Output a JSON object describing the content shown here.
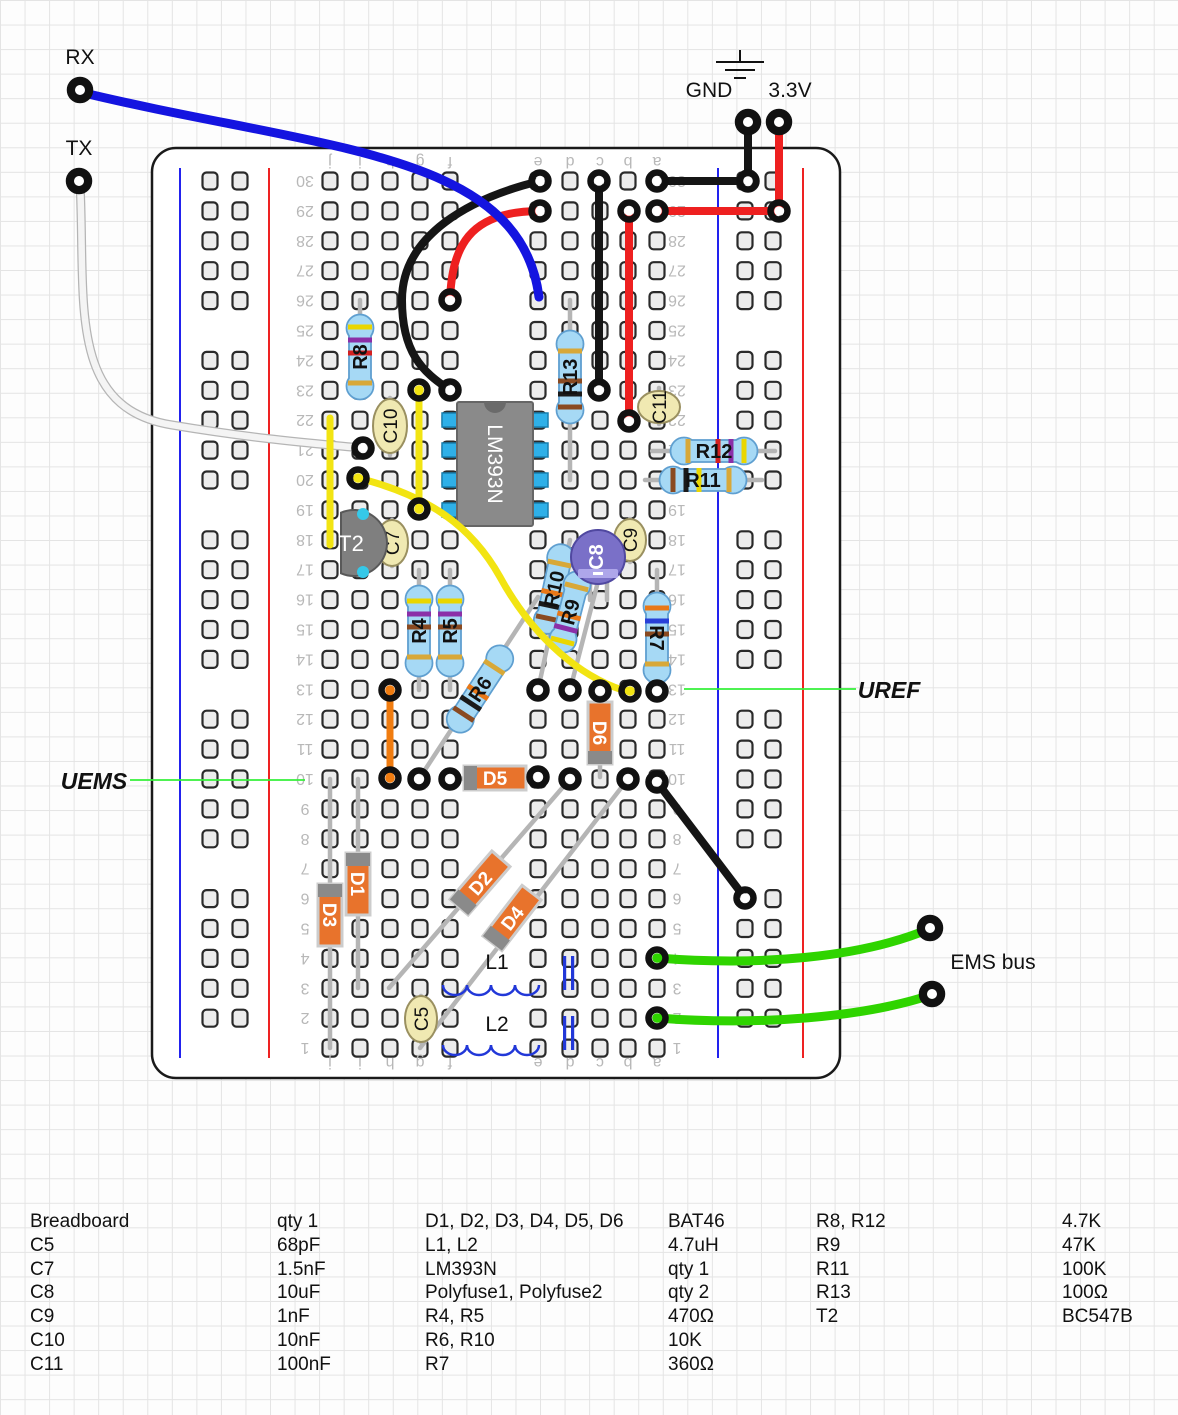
{
  "labels": {
    "rx": "RX",
    "tx": "TX",
    "gnd": "GND",
    "v33": "3.3V",
    "uref": "UREF",
    "uems": "UEMS",
    "ems_bus": "EMS bus"
  },
  "colors": {
    "board_fill": "#ffffff",
    "board_stroke": "#1a1a1a",
    "hole_fill": "#ececec",
    "hole_stroke": "#2a2a2a",
    "rail_blue": "#2222ee",
    "rail_red": "#ee2222",
    "row_label": "#b8b8b8",
    "wire_black": "#151515",
    "wire_red": "#ee2020",
    "wire_blue": "#1414e0",
    "wire_yellow": "#f2e412",
    "wire_orange": "#f07c10",
    "wire_green": "#2fd400",
    "wire_white": "#f4f4f4",
    "wire_white_outline": "#b5b5b5",
    "lead_gray": "#b5b5b5",
    "resistor_body": "#a6d9f5",
    "resistor_stroke": "#5f9fd0",
    "diode_body": "#e8732c",
    "diode_stroke": "#cccccc",
    "diode_band": "#8a8a8a",
    "cap_body": "#f0e9b2",
    "cap_stroke": "#9a9060",
    "electro_body": "#7a70c8",
    "electro_stroke": "#5048a0",
    "electro_stripe": "#aea6ea",
    "transistor_body": "#7f7f7f",
    "transistor_stroke": "#595959",
    "transistor_pin": "#35c8e8",
    "ic_body": "#8a8a8a",
    "ic_stroke": "#666666",
    "ic_pin": "#2fb0e8",
    "ic_notch": "#6a6a6a",
    "inductor_blue": "#2238d8",
    "callout_green": "#35f03a",
    "band_colors": {
      "yellow": "#ead600",
      "violet": "#8b2fa8",
      "red": "#d42020",
      "brown": "#8a4a21",
      "black": "#1a1a1a",
      "orange": "#e87818",
      "blue": "#2840d8",
      "gold": "#d8a838"
    }
  },
  "board": {
    "x": 152,
    "y": 148,
    "w": 688,
    "h": 930,
    "radius": 24,
    "rows": 30,
    "row30_y": 181,
    "row_pitch": 29.9,
    "col_letters": [
      "j",
      "i",
      "h",
      "g",
      "f",
      "e",
      "d",
      "c",
      "b",
      "a"
    ],
    "col_x": [
      330,
      360,
      390,
      420,
      450,
      538,
      570,
      600,
      628,
      657
    ],
    "letters_top_y": 162,
    "letters_bottom_y": 1063,
    "row_label_left_x": 305,
    "row_label_right_x": 677,
    "rails": {
      "left": {
        "blue_line_x": 180,
        "red_line_x": 269,
        "hole_x": [
          210,
          240
        ]
      },
      "right": {
        "blue_line_x": 718,
        "red_line_x": 803,
        "hole_x": [
          745,
          773
        ]
      },
      "groups": [
        [
          30,
          26
        ],
        [
          24,
          20
        ],
        [
          18,
          14
        ],
        [
          12,
          8
        ],
        [
          6,
          2
        ]
      ]
    }
  },
  "ic": {
    "ref": "LM393N",
    "x": 457,
    "y": 402,
    "w": 76,
    "h": 124,
    "pin_rows": [
      420,
      450,
      480,
      510
    ]
  },
  "transistor": {
    "ref": "T2",
    "cx": 354,
    "cy": 543,
    "r": 33,
    "flat_x": 341,
    "pins": [
      [
        363,
        514
      ],
      [
        363,
        572
      ]
    ],
    "label_x": 351,
    "label_y": 551
  },
  "resistors": [
    {
      "ref": "R8",
      "value": "4.7K",
      "lead": [
        360,
        300,
        360,
        390
      ],
      "cx": 360,
      "cy": 357,
      "len": 82,
      "angle": -90,
      "bands": [
        "yellow",
        "violet",
        "red"
      ],
      "flip": true
    },
    {
      "ref": "R13",
      "value": "100",
      "lead": [
        570,
        300,
        570,
        480
      ],
      "cx": 570,
      "cy": 377,
      "len": 90,
      "angle": -90,
      "bands": [
        "brown",
        "black",
        "brown"
      ],
      "flip": false
    },
    {
      "ref": "R4",
      "value": "470",
      "lead": [
        419,
        570,
        419,
        690
      ],
      "cx": 419,
      "cy": 631,
      "len": 88,
      "angle": -90,
      "bands": [
        "yellow",
        "violet",
        "brown"
      ],
      "flip": true
    },
    {
      "ref": "R5",
      "value": "470",
      "lead": [
        450,
        570,
        450,
        690
      ],
      "cx": 450,
      "cy": 631,
      "len": 88,
      "angle": -90,
      "bands": [
        "yellow",
        "violet",
        "brown"
      ],
      "flip": true
    },
    {
      "ref": "R6",
      "value": "10K",
      "lead": [
        419,
        779,
        538,
        597
      ],
      "cx": 480,
      "cy": 689,
      "len": 96,
      "angle": -56.8,
      "bands": [
        "brown",
        "black",
        "orange"
      ],
      "flip": false
    },
    {
      "ref": "R10",
      "value": "10K",
      "lead": [
        538,
        690,
        570,
        540
      ],
      "cx": 554,
      "cy": 589,
      "len": 88,
      "angle": -78,
      "bands": [
        "brown",
        "black",
        "orange"
      ],
      "flip": false
    },
    {
      "ref": "R9",
      "value": "47K",
      "lead": [
        570,
        690,
        601,
        570
      ],
      "cx": 570,
      "cy": 612,
      "len": 80,
      "angle": -75.5,
      "bands": [
        "yellow",
        "violet",
        "orange"
      ],
      "flip": false
    },
    {
      "ref": "R7",
      "value": "360",
      "lead": [
        657,
        570,
        657,
        691
      ],
      "cx": 657,
      "cy": 638,
      "len": 88,
      "angle": 90,
      "bands": [
        "orange",
        "blue",
        "brown"
      ],
      "flip": false
    },
    {
      "ref": "R12",
      "value": "4.7K",
      "lead": [
        652,
        451,
        775,
        451
      ],
      "cx": 714,
      "cy": 451,
      "len": 84,
      "angle": 0,
      "bands": [
        "yellow",
        "violet",
        "red"
      ],
      "flip": true
    },
    {
      "ref": "R11",
      "value": "100K",
      "lead": [
        645,
        480,
        762,
        480
      ],
      "cx": 703,
      "cy": 480,
      "len": 84,
      "angle": 0,
      "bands": [
        "brown",
        "black",
        "yellow"
      ],
      "flip": false
    }
  ],
  "diodes": [
    {
      "ref": "D5",
      "lead": [
        447,
        779,
        538,
        777
      ],
      "cx": 495,
      "cy": 778,
      "len": 62,
      "angle": 0,
      "band_side": -1
    },
    {
      "ref": "D6",
      "lead": [
        600,
        691,
        600,
        777
      ],
      "cx": 600,
      "cy": 733,
      "len": 62,
      "angle": 90,
      "band_side": 1
    },
    {
      "ref": "D3",
      "lead": [
        330,
        779,
        330,
        1048
      ],
      "cx": 330,
      "cy": 915,
      "len": 62,
      "angle": 90,
      "band_side": -1
    },
    {
      "ref": "D1",
      "lead": [
        358,
        779,
        358,
        988
      ],
      "cx": 358,
      "cy": 884,
      "len": 62,
      "angle": 90,
      "band_side": -1
    },
    {
      "ref": "D2",
      "lead": [
        389,
        988,
        570,
        779
      ],
      "cx": 480,
      "cy": 883,
      "len": 64,
      "angle": -49.1,
      "band_side": -1
    },
    {
      "ref": "D4",
      "lead": [
        420,
        1048,
        628,
        779
      ],
      "cx": 512,
      "cy": 918,
      "len": 64,
      "angle": -52.3,
      "band_side": -1
    }
  ],
  "capacitors": [
    {
      "ref": "C10",
      "cx": 390,
      "cy": 426,
      "rx": 17,
      "ry": 27,
      "stub": [
        390,
        398,
        455
      ]
    },
    {
      "ref": "C7",
      "cx": 392,
      "cy": 543,
      "rx": 16,
      "ry": 23,
      "stub": [
        392,
        520,
        566
      ]
    },
    {
      "ref": "C9",
      "cx": 630,
      "cy": 540,
      "rx": 16,
      "ry": 21,
      "stub": [
        630,
        519,
        562
      ]
    },
    {
      "ref": "C5",
      "cx": 421,
      "cy": 1019,
      "rx": 16,
      "ry": 23,
      "stub": [
        421,
        996,
        1042
      ]
    },
    {
      "ref": "C11",
      "cx": 659,
      "cy": 407,
      "rx": 21,
      "ry": 16,
      "stub": [
        659,
        388,
        424
      ]
    }
  ],
  "electrolytic": {
    "ref": "C8",
    "cx": 598,
    "cy": 557,
    "r": 27,
    "minus": "-",
    "stubs": [
      [
        590,
        583,
        600
      ],
      [
        607,
        583,
        600
      ]
    ]
  },
  "inductors": [
    {
      "ref": "L1",
      "path": "M443,985 a12,10 0 0 0 24,0 a12,10 0 0 0 24,0 a12,10 0 0 0 24,0 a12,10 0 0 0 24,0",
      "label_x": 497,
      "label_y": 969
    },
    {
      "ref": "L2",
      "path": "M443,1045 a12,10 0 0 0 24,0 a12,10 0 0 0 24,0 a12,10 0 0 0 24,0 a12,10 0 0 0 24,0",
      "label_x": 497,
      "label_y": 1031
    }
  ],
  "polyfuses": [
    {
      "name": "polyfuse-1",
      "x": 563,
      "y1": 956,
      "y2": 990
    },
    {
      "name": "polyfuse-2",
      "x": 563,
      "y1": 1016,
      "y2": 1050
    }
  ],
  "wires": [
    {
      "name": "wire-tx-white",
      "color": "white",
      "w": 6.5,
      "path": "M80,183 C86,300 66,408 172,425 C262,440 322,444 361,448"
    },
    {
      "name": "wire-gnd-drop",
      "color": "black",
      "w": 8,
      "path": "M748,130 L748,181"
    },
    {
      "name": "wire-gnd-row30",
      "color": "black",
      "w": 8,
      "path": "M657,181 L748,181"
    },
    {
      "name": "wire-33v-drop",
      "color": "red",
      "w": 8,
      "path": "M779,130 L779,211"
    },
    {
      "name": "wire-33v-row29",
      "color": "red",
      "w": 8,
      "path": "M657,211 L779,211"
    },
    {
      "name": "wire-black-vertical",
      "color": "black",
      "w": 8,
      "path": "M599,181 L599,390"
    },
    {
      "name": "wire-red-vertical",
      "color": "red",
      "w": 8,
      "path": "M629,211 L629,421"
    },
    {
      "name": "wire-black-curve",
      "color": "black",
      "w": 8,
      "path": "M540,181 C470,198 402,235 402,300 C402,352 422,372 450,390"
    },
    {
      "name": "wire-red-curve",
      "color": "red",
      "w": 8,
      "path": "M450,300 C452,248 468,211 540,211"
    },
    {
      "name": "wire-rx-blue",
      "color": "blue",
      "w": 9,
      "path": "M80,92 C320,150 520,150 539,297"
    },
    {
      "name": "wire-yellow-left",
      "color": "yellow",
      "w": 7,
      "path": "M330,418 L330,545"
    },
    {
      "name": "wire-yellow-g",
      "color": "yellow",
      "w": 7,
      "path": "M419,390 L419,509"
    },
    {
      "name": "wire-orange",
      "color": "orange",
      "w": 7,
      "path": "M390,690 L390,778"
    },
    {
      "name": "wire-yellow-long",
      "color": "yellow",
      "w": 7,
      "path": "M358,478 C430,496 472,527 500,577 C530,632 572,670 614,687 C622,690 627,691 630,691"
    },
    {
      "name": "wire-black-diagonal",
      "color": "black",
      "w": 8,
      "path": "M657,782 L745,898"
    },
    {
      "name": "wire-green-ems-1",
      "color": "green",
      "w": 9,
      "path": "M657,958 C760,966 860,958 929,929"
    },
    {
      "name": "wire-green-ems-2",
      "color": "green",
      "w": 9,
      "path": "M657,1018 C762,1026 864,1017 931,995"
    }
  ],
  "rings": [
    [
      657,
      181,
      "w"
    ],
    [
      748,
      181,
      "w"
    ],
    [
      657,
      211,
      "w"
    ],
    [
      779,
      211,
      "w"
    ],
    [
      599,
      181,
      "w"
    ],
    [
      599,
      390,
      "w"
    ],
    [
      629,
      211,
      "w"
    ],
    [
      629,
      421,
      "w"
    ],
    [
      540,
      181,
      "w"
    ],
    [
      450,
      390,
      "w"
    ],
    [
      450,
      300,
      "w"
    ],
    [
      540,
      211,
      "w"
    ],
    [
      363,
      448,
      "w"
    ],
    [
      358,
      478,
      "y"
    ],
    [
      630,
      691,
      "y"
    ],
    [
      419,
      390,
      "y"
    ],
    [
      419,
      509,
      "y"
    ],
    [
      390,
      690,
      "o"
    ],
    [
      390,
      778,
      "o"
    ],
    [
      657,
      782,
      "w"
    ],
    [
      745,
      898,
      "w"
    ],
    [
      657,
      958,
      "g"
    ],
    [
      657,
      1018,
      "g"
    ],
    [
      538,
      690,
      "w"
    ],
    [
      570,
      690,
      "w"
    ],
    [
      600,
      691,
      "w"
    ],
    [
      657,
      691,
      "w"
    ],
    [
      538,
      777,
      "w"
    ],
    [
      450,
      779,
      "w"
    ],
    [
      570,
      779,
      "w"
    ],
    [
      628,
      779,
      "w"
    ],
    [
      419,
      779,
      "w"
    ]
  ],
  "pads": [
    {
      "name": "pad-rx",
      "x": 80,
      "y": 90
    },
    {
      "name": "pad-tx",
      "x": 79,
      "y": 181
    },
    {
      "name": "pad-gnd",
      "x": 748,
      "y": 122
    },
    {
      "name": "pad-33v",
      "x": 779,
      "y": 122
    },
    {
      "name": "pad-ems-1",
      "x": 930,
      "y": 928
    },
    {
      "name": "pad-ems-2",
      "x": 932,
      "y": 994
    }
  ],
  "gnd_symbol": {
    "stem": [
      740,
      50,
      740,
      62
    ],
    "bars": [
      [
        716,
        62,
        764,
        62
      ],
      [
        725,
        70,
        755,
        70
      ],
      [
        734,
        78,
        746,
        78
      ]
    ]
  },
  "ext_labels": [
    {
      "key": "rx",
      "x": 80,
      "y": 64,
      "size": 21,
      "style": "plain"
    },
    {
      "key": "tx",
      "x": 79,
      "y": 155,
      "size": 21,
      "style": "plain"
    },
    {
      "key": "gnd",
      "x": 709,
      "y": 97,
      "size": 21,
      "style": "plain"
    },
    {
      "key": "v33",
      "x": 790,
      "y": 97,
      "size": 21,
      "style": "plain"
    },
    {
      "key": "ems_bus",
      "x": 993,
      "y": 969,
      "size": 21,
      "style": "plain"
    },
    {
      "key": "uref",
      "x": 889,
      "y": 698,
      "size": 23,
      "style": "bold-italic"
    },
    {
      "key": "uems",
      "x": 94,
      "y": 789,
      "size": 23,
      "style": "bold-italic"
    }
  ],
  "callout_lines": [
    [
      684,
      689,
      856,
      689
    ],
    [
      130,
      780,
      305,
      780
    ]
  ],
  "parts_list": {
    "top": 1212,
    "row_h": 23.8,
    "groups": [
      {
        "x_name": 30,
        "x_value": 277,
        "rows": [
          [
            "Breadboard",
            "qty 1"
          ],
          [
            "C5",
            "68pF"
          ],
          [
            "C7",
            "1.5nF"
          ],
          [
            "C8",
            "10uF"
          ],
          [
            "C9",
            "1nF"
          ],
          [
            "C10",
            "10nF"
          ],
          [
            "C11",
            "100nF"
          ]
        ]
      },
      {
        "x_name": 425,
        "x_value": 668,
        "rows": [
          [
            "D1, D2, D3, D4, D5, D6",
            "BAT46"
          ],
          [
            "L1, L2",
            "4.7uH"
          ],
          [
            "LM393N",
            "qty 1"
          ],
          [
            "Polyfuse1, Polyfuse2",
            "qty 2"
          ],
          [
            "R4, R5",
            "470Ω"
          ],
          [
            "R6, R10",
            "10K"
          ],
          [
            "R7",
            "360Ω"
          ]
        ]
      },
      {
        "x_name": 816,
        "x_value": 1062,
        "rows": [
          [
            "R8, R12",
            "4.7K"
          ],
          [
            "R9",
            "47K"
          ],
          [
            "R11",
            "100K"
          ],
          [
            "R13",
            "100Ω"
          ],
          [
            "T2",
            "BC547B"
          ]
        ]
      }
    ]
  }
}
